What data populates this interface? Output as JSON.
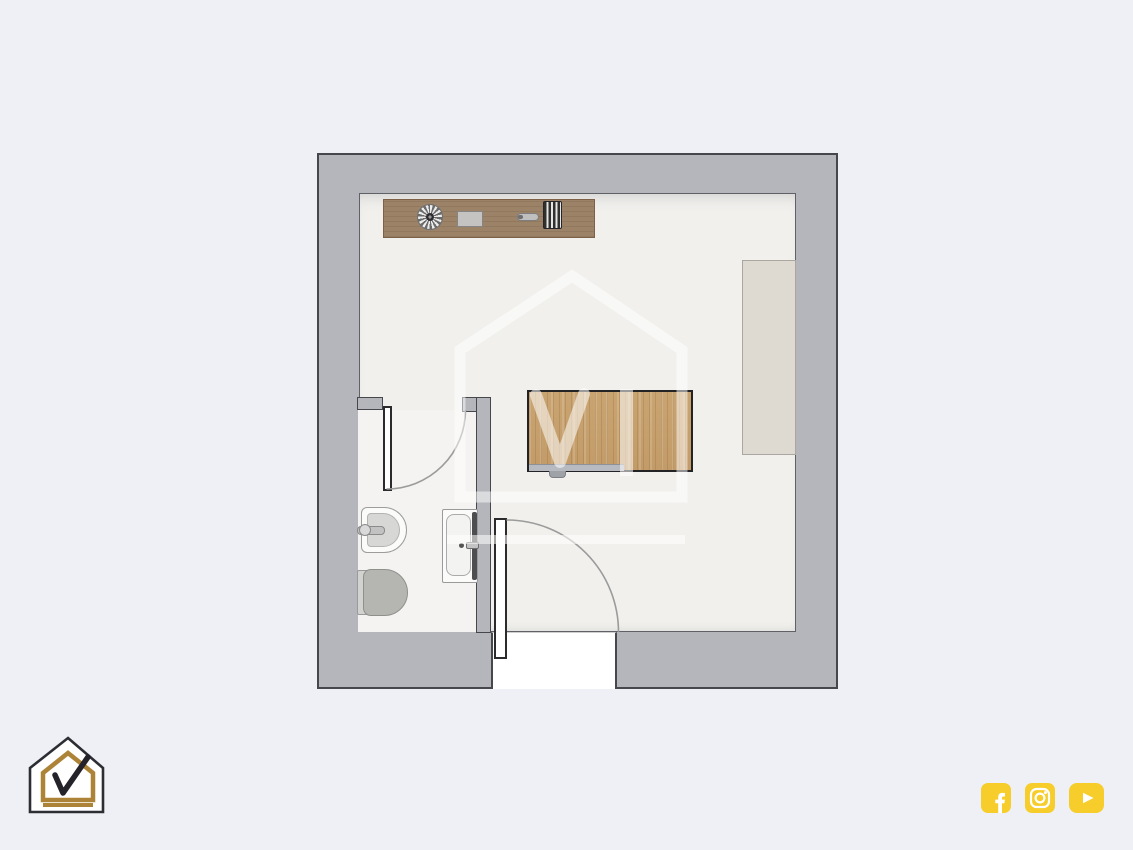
{
  "meta": {
    "kind": "architectural floor plan rendering",
    "description": "Top-down 2D floor plan of a studio room with en-suite bathroom"
  },
  "theme": {
    "page_bg": "#eef0f6",
    "wall_fill": "#b4b6bb",
    "wall_outline": "#45474d",
    "floor_main": "#f1f0ed",
    "floor_bath": "#f4f3f1",
    "desk_wood": "#9c8267",
    "table_wood": "#c9a471",
    "table_outline": "#232325",
    "panel_beige": "#dedad1",
    "fixture_white": "#fbfbfa",
    "fixture_gray": "#b5b5b2",
    "arc_stroke": "#9b9b9b",
    "brand_gold": "#ad8437",
    "brand_dark": "#2d2e34",
    "social_yellow": "#f6cd2b"
  },
  "floorplan": {
    "rooms": [
      {
        "label": "Main room"
      },
      {
        "label": "Bathroom"
      }
    ],
    "furniture": [
      {
        "label": "Wall desk with decor items"
      },
      {
        "label": "Desk fan"
      },
      {
        "label": "Tray"
      },
      {
        "label": "Pen"
      },
      {
        "label": "Book stack"
      },
      {
        "label": "Wooden table"
      },
      {
        "label": "Wardrobe panel"
      }
    ],
    "bathroom_fixtures": [
      {
        "label": "Bidet"
      },
      {
        "label": "Toilet"
      },
      {
        "label": "Washbasin vanity"
      }
    ],
    "doors": [
      {
        "label": "Bathroom door with quarter-circle swing"
      },
      {
        "label": "Entrance door with quarter-circle swing"
      }
    ]
  },
  "branding": {
    "logo_label": "House-with-checkmark logo",
    "watermark_label": "House-with-checkmark watermark"
  },
  "social": {
    "icons": [
      {
        "name": "facebook",
        "label": "Facebook"
      },
      {
        "name": "instagram",
        "label": "Instagram"
      },
      {
        "name": "youtube",
        "label": "YouTube"
      }
    ]
  }
}
